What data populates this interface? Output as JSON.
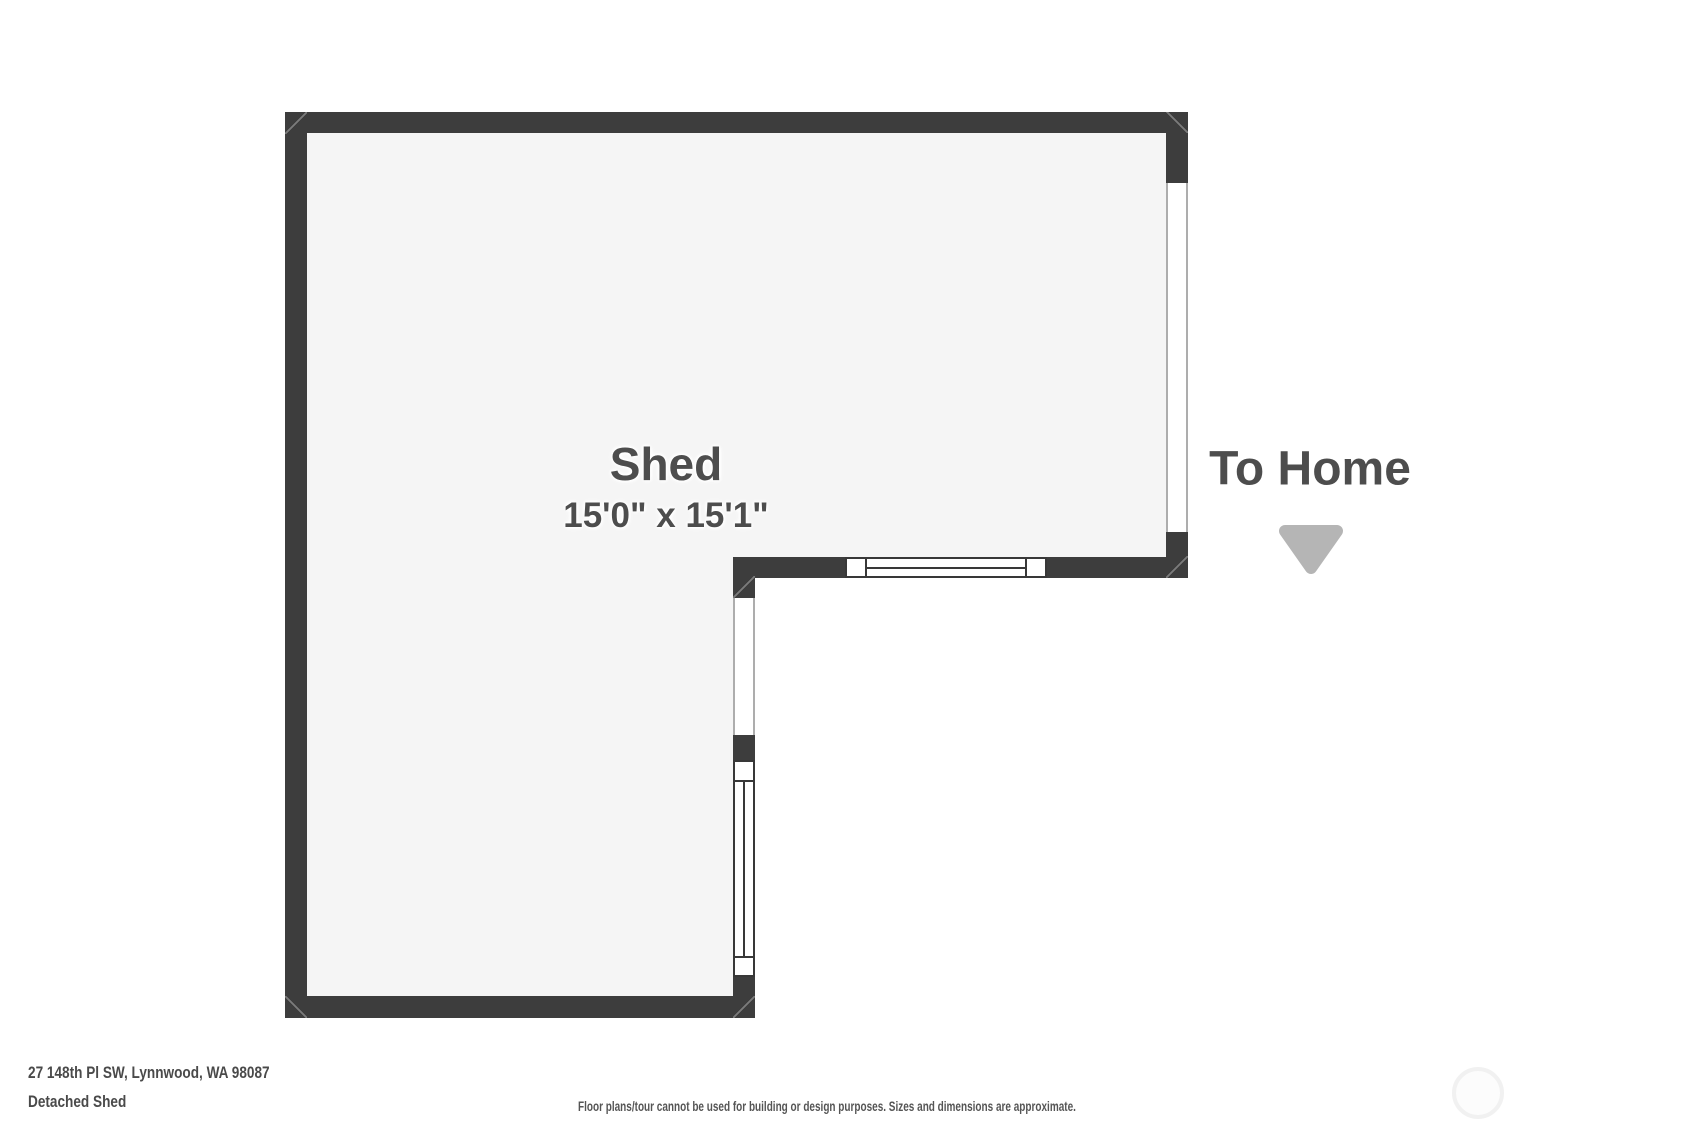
{
  "floor_plan": {
    "room_label": "Shed",
    "room_dimensions": "15'0\" x 15'1\"",
    "direction_label": "To Home",
    "direction_arrow_icon": "triangle-down",
    "symbols": {
      "right_wall_opening": "wall-opening-to-home",
      "interior_doorway": "wall-opening-doorway",
      "bottom_wall_window": "window-symbol",
      "lower_right_wall_window": "window-symbol"
    }
  },
  "footer": {
    "address": "27 148th Pl SW, Lynnwood, WA 98087",
    "plan_name": "Detached Shed",
    "disclaimer": "Floor plans/tour cannot be used for building or design purposes. Sizes and dimensions are approximate."
  },
  "watermark_icon": "circle-outline",
  "colors": {
    "wall": "#3d3d3d",
    "floor": "#f5f5f5",
    "background": "#ffffff",
    "label_text": "#4d4d4d",
    "footer_text": "#4a4a4a",
    "arrow": "#b5b5b5",
    "opening_line": "#adadad",
    "window_frame": "#383838"
  }
}
